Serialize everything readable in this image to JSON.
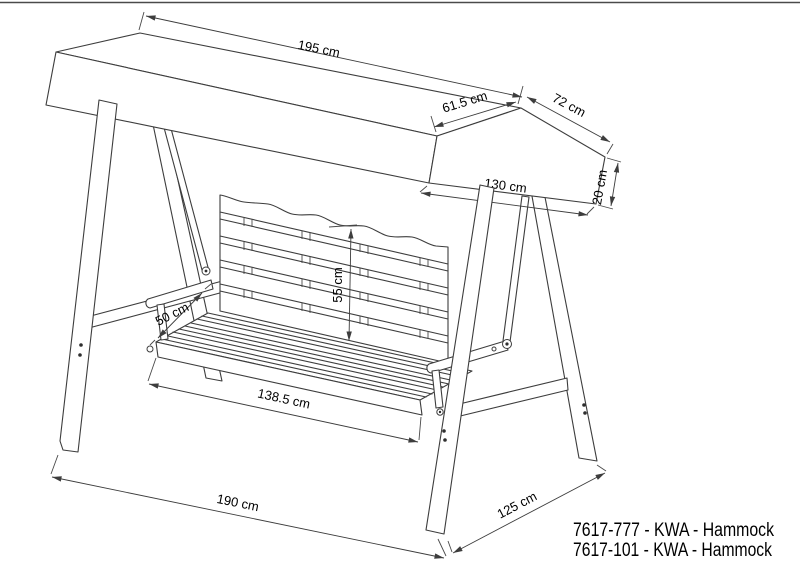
{
  "page": {
    "background": "#ffffff",
    "line_color": "#3d3d3d",
    "text_color": "#000000"
  },
  "drawing": {
    "kind": "technical dimension drawing",
    "subject": "canopy swing hammock with A-frame stand and slatted bench",
    "dims": {
      "canopy_length": "195 cm",
      "canopy_front_panel": "61.5 cm",
      "canopy_rear_panel": "72 cm",
      "canopy_end_width": "130 cm",
      "canopy_valance_height": "20 cm",
      "backrest_height": "55 cm",
      "seat_depth": "50 cm",
      "seat_width": "138.5 cm",
      "frame_width": "190 cm",
      "frame_depth": "125 cm"
    },
    "product_codes": [
      "7617-777 - KWA - Hammock",
      "7617-101 - KWA - Hammock"
    ]
  }
}
